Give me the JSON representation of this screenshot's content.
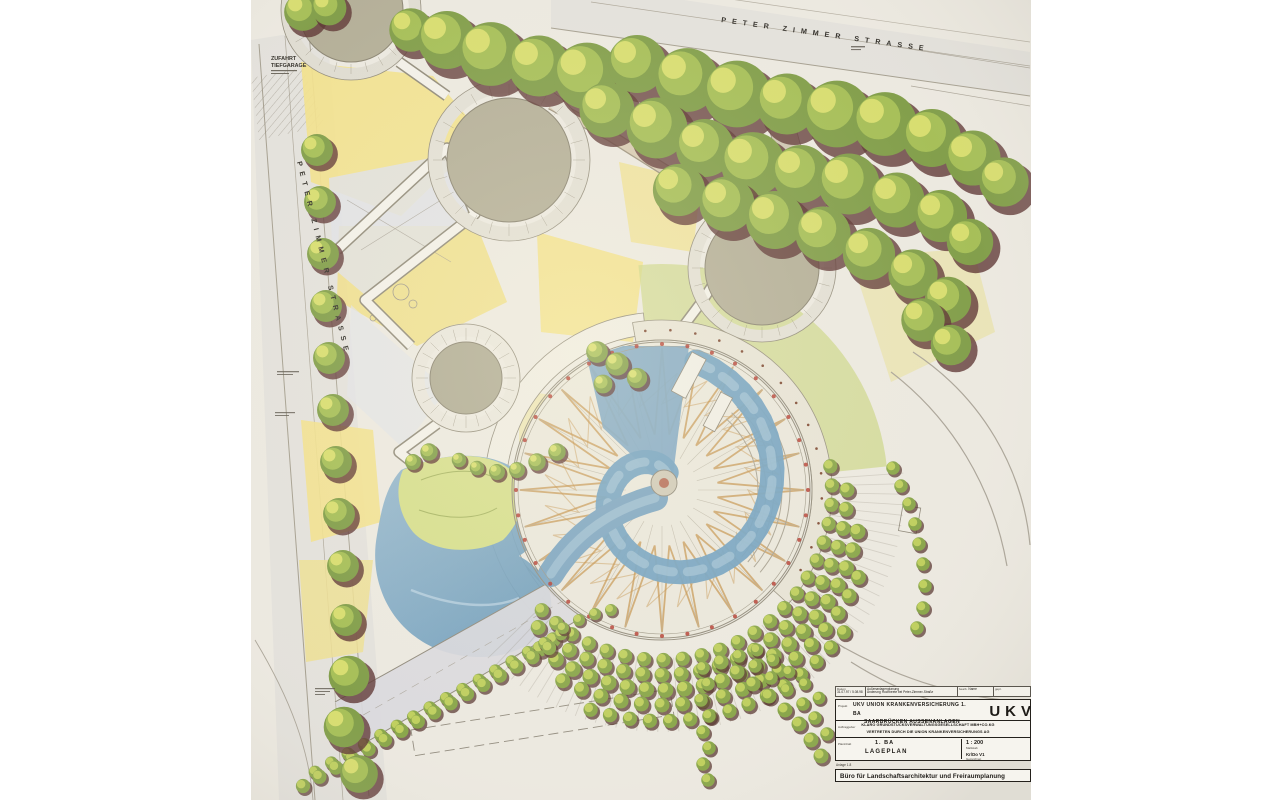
{
  "streets": {
    "top": {
      "name": "PETER ZIMMER STRASSE"
    },
    "left": {
      "name": "PETER ZIMMER STRASSE"
    }
  },
  "annotations": {
    "garage_line1": "ZUFAHRT",
    "garage_line2": "TIEFGARAGE"
  },
  "palette": {
    "paper": "#ece9e1",
    "water": "#6f9fc0",
    "lawn_yellow": "#f2e189",
    "lawn_green": "#cbd584",
    "tree_green": "#7d9b44",
    "tree_shadow": "#5a3130",
    "accent_red": "#b13429",
    "paving": "#b2ad96",
    "zigzag_orange": "#c08a3e"
  },
  "titleblock": {
    "revision": {
      "date_label": "Datum",
      "dates": "31.07.97 / 5.08.98",
      "change_line1": "Außenanlagenplanung",
      "change_line2": "Änderung Hochbeete bei Peter-Zimmer-Straße",
      "bearb_label": "bearb.",
      "bearb": "Name",
      "gepr_label": "gepr."
    },
    "project": {
      "label": "Projekt",
      "line1": "UKV UNION KRANKENVERSICHERUNG 1. BA",
      "line2": "SAARBRÜCKEN AUSSENANLAGEN",
      "logo": "UKV"
    },
    "client": {
      "label": "Auftraggeber",
      "line1": "KLARO GRUNDSTÜCKSVERWALTUNGSGESELLSCHAFT MBH+CO.KG",
      "line2": "VERTRETEN DURCH DIE UNION KRANKENVERSICHERUNGS AG"
    },
    "plan": {
      "label": "Planinhalt",
      "phase": "1. BA",
      "title": "LAGEPLAN",
      "scale_label": "Maßstab",
      "scale": "1 : 200",
      "drawn": "Kr/Do  V1",
      "drawn_label": "Gezeichnet"
    },
    "note": "Anlage 1.8",
    "firm": "Büro für Landschaftsarchitektur und Freiraumplanung"
  }
}
